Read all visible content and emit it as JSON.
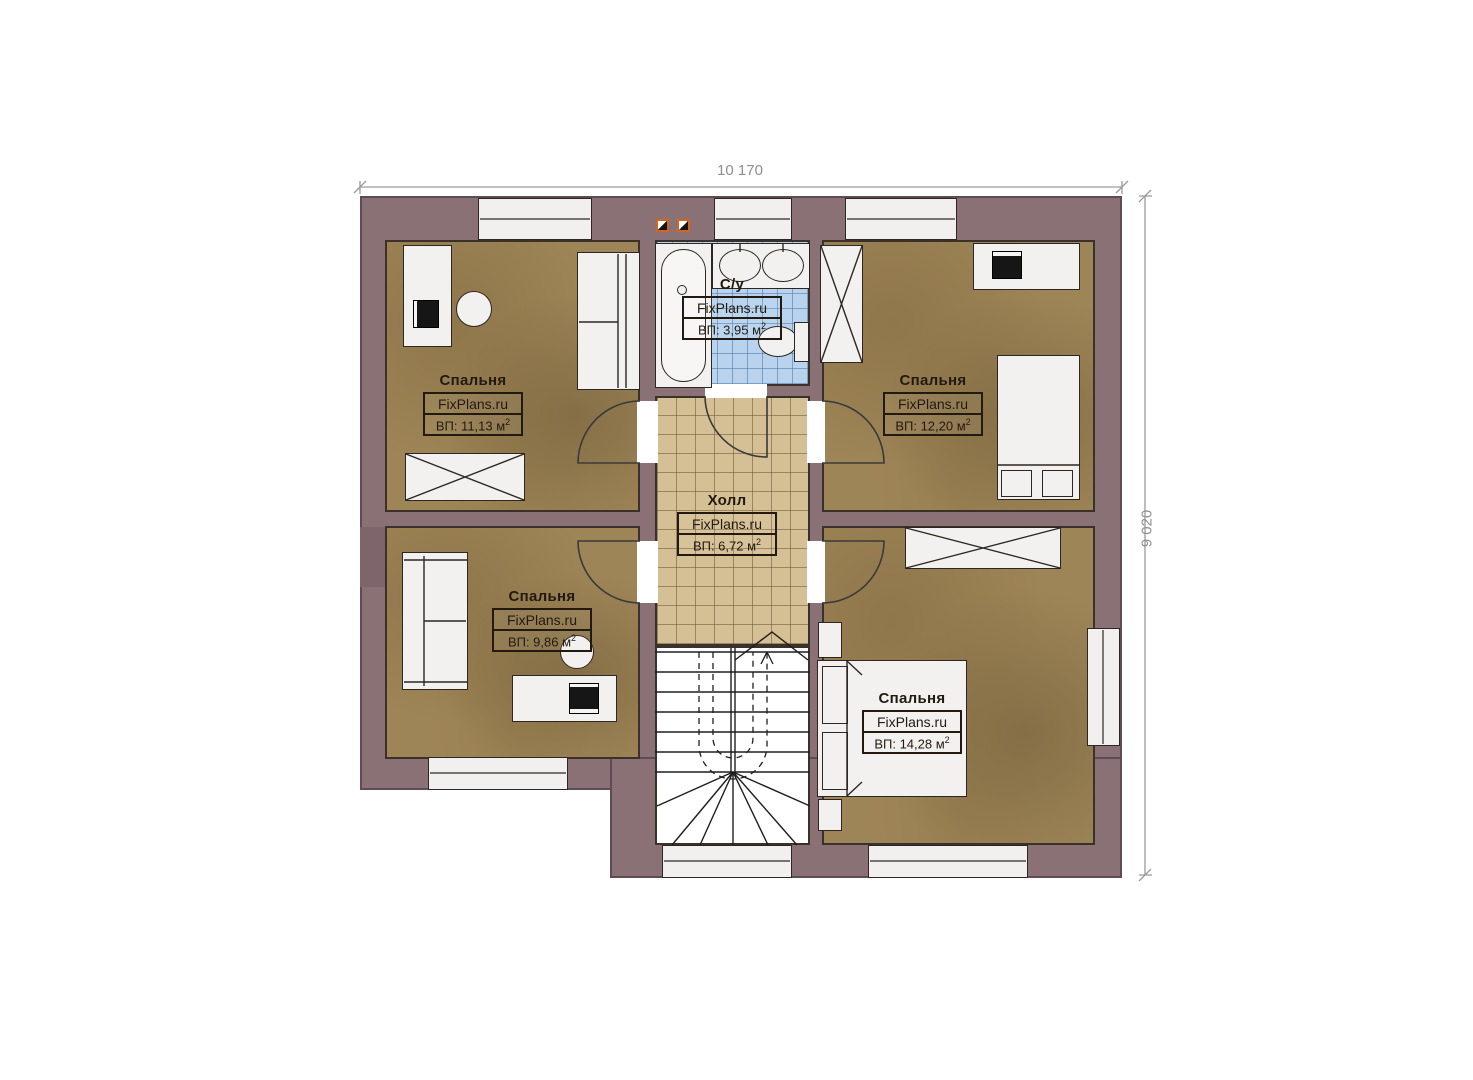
{
  "plan": {
    "watermark": "FixPlans.ru",
    "sup": "2",
    "dimensions": {
      "width": "10 170",
      "height": "9 020"
    },
    "rooms": {
      "bedroom_tl": {
        "name": "Спальня",
        "area": "ВП: 11,13 м"
      },
      "bathroom": {
        "name": "С/у",
        "area": "ВП: 3,95 м"
      },
      "bedroom_tr": {
        "name": "Спальня",
        "area": "ВП: 12,20 м"
      },
      "hall": {
        "name": "Холл",
        "area": "ВП: 6,72 м"
      },
      "bedroom_bl": {
        "name": "Спальня",
        "area": "ВП: 9,86 м"
      },
      "bedroom_br": {
        "name": "Спальня",
        "area": "ВП: 14,28 м"
      }
    },
    "colors": {
      "wall": "#8a7176",
      "bedroom_floor": "#9e8557",
      "hall_floor": "#d5bf95",
      "bath_floor": "#b9d3ee",
      "furniture": "#f2f1ef",
      "outline": "#2c2722",
      "dimension_text": "#8f8f8f",
      "vent_accent": "#d4651f"
    }
  }
}
